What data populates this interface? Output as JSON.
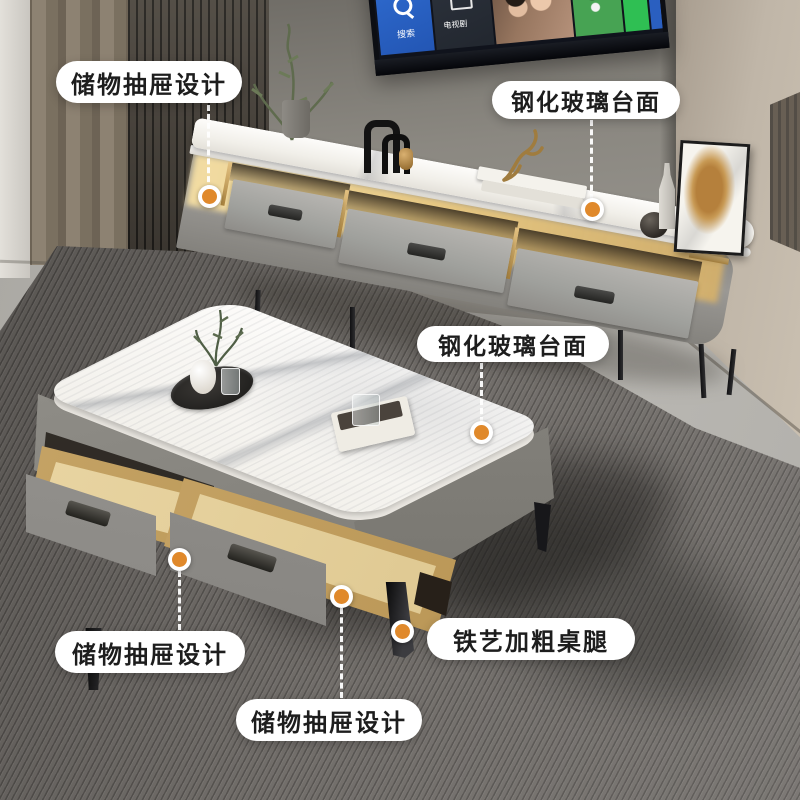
{
  "callouts": [
    {
      "id": "drawer-design-top",
      "label": "储物抽屉设计"
    },
    {
      "id": "glass-top-tv-stand",
      "label": "钢化玻璃台面"
    },
    {
      "id": "glass-top-coffee-table",
      "label": "钢化玻璃台面"
    },
    {
      "id": "drawer-design-left",
      "label": "储物抽屉设计"
    },
    {
      "id": "iron-legs",
      "label": "铁艺加粗桌腿"
    },
    {
      "id": "drawer-design-center",
      "label": "储物抽屉设计"
    }
  ],
  "tv": {
    "tiles": [
      {
        "name": "search-tile",
        "label": "搜索"
      },
      {
        "name": "tv-series-tile",
        "label": "电视剧"
      },
      {
        "name": "variety-tile",
        "label": "综艺"
      }
    ]
  },
  "colors": {
    "accent_orange": "#e0892b",
    "pill_bg": "#ffffff",
    "pill_text": "#1d1d1d",
    "glow_warm": "#f3d795"
  }
}
